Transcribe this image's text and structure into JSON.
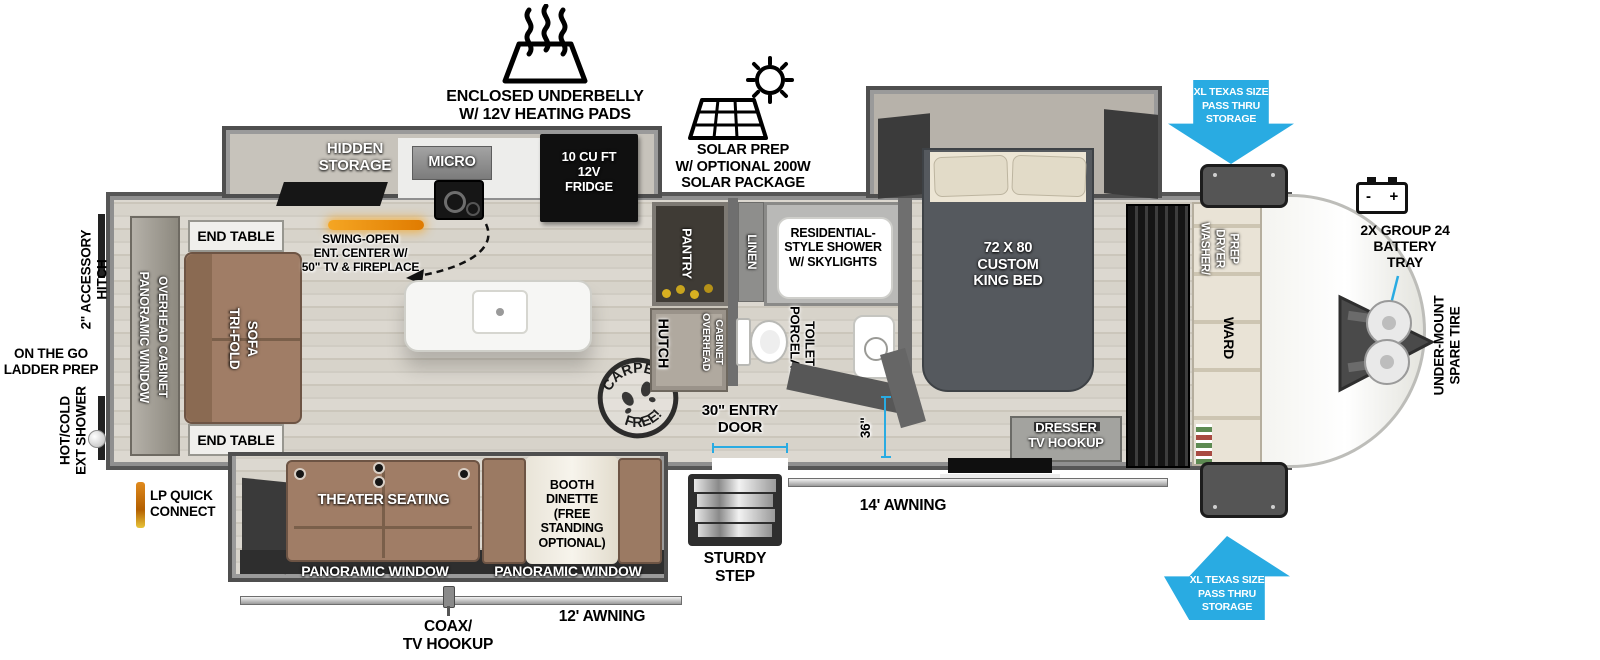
{
  "exterior": {
    "underbelly": "ENCLOSED UNDERBELLY\nW/ 12V HEATING PADS",
    "solar": "SOLAR PREP\nW/ OPTIONAL 200W\nSOLAR PACKAGE",
    "pass_thru_front_top": "XL TEXAS SIZE\nPASS THRU\nSTORAGE",
    "pass_thru_front_bottom": "XL TEXAS SIZE\nPASS THRU\nSTORAGE",
    "battery_tray": "2X GROUP 24\nBATTERY\nTRAY",
    "battery_minus": "-",
    "battery_plus": "+",
    "spare_tire": "UNDER-MOUNT\nSPARE TIRE",
    "accessory_hitch": "2\" ACCESSORY\nHITCH",
    "ladder_prep": "ON THE GO\nLADDER PREP",
    "ext_shower": "HOT/COLD\nEXT SHOWER",
    "lp_quick_connect": "LP QUICK\nCONNECT",
    "coax_tv": "COAX/\nTV HOOKUP",
    "awning_main": "14' AWNING",
    "awning_slide": "12' AWNING",
    "sturdy_step": "STURDY\nSTEP",
    "entry_door": "30\" ENTRY\nDOOR",
    "entry_width_dim": "36\""
  },
  "stamp": {
    "top": "CARPET",
    "bottom": "FREE!"
  },
  "living": {
    "end_table_top": "END TABLE",
    "end_table_bottom": "END TABLE",
    "sofa_line1": "TRI-FOLD",
    "sofa_line2": "SOFA",
    "rear_window": "PANORAMIC WINDOW",
    "rear_cabinet": "OVERHEAD CABINET",
    "theater": "THEATER SEATING",
    "dinette": "BOOTH\nDINETTE\n(FREE\nSTANDING\nOPTIONAL)",
    "window_left": "PANORAMIC WINDOW",
    "window_right": "PANORAMIC WINDOW"
  },
  "kitchen": {
    "hidden_storage": "HIDDEN\nSTORAGE",
    "micro": "MICRO",
    "fridge": "10 CU FT\n12V\nFRIDGE",
    "ent_center": "SWING-OPEN\nENT. CENTER W/\n50\" TV & FIREPLACE",
    "pantry": "PANTRY",
    "hutch": "HUTCH",
    "hutch_overhead_line1": "OVERHEAD",
    "hutch_overhead_line2": "CABINET"
  },
  "bath": {
    "linen": "LINEN",
    "shower": "RESIDENTIAL-\nSTYLE SHOWER\nW/ SKYLIGHTS",
    "toilet_line1": "PORCELAIN",
    "toilet_line2": "TOILET"
  },
  "bedroom": {
    "bed": "72 X 80\nCUSTOM\nKING BED",
    "dresser": "DRESSER\nTV HOOKUP"
  },
  "front": {
    "washer_line1": "WASHER/",
    "washer_line2": "DRYER",
    "washer_line3": "PREP",
    "ward": "WARD"
  },
  "colors": {
    "accent": "#29ABE2"
  }
}
